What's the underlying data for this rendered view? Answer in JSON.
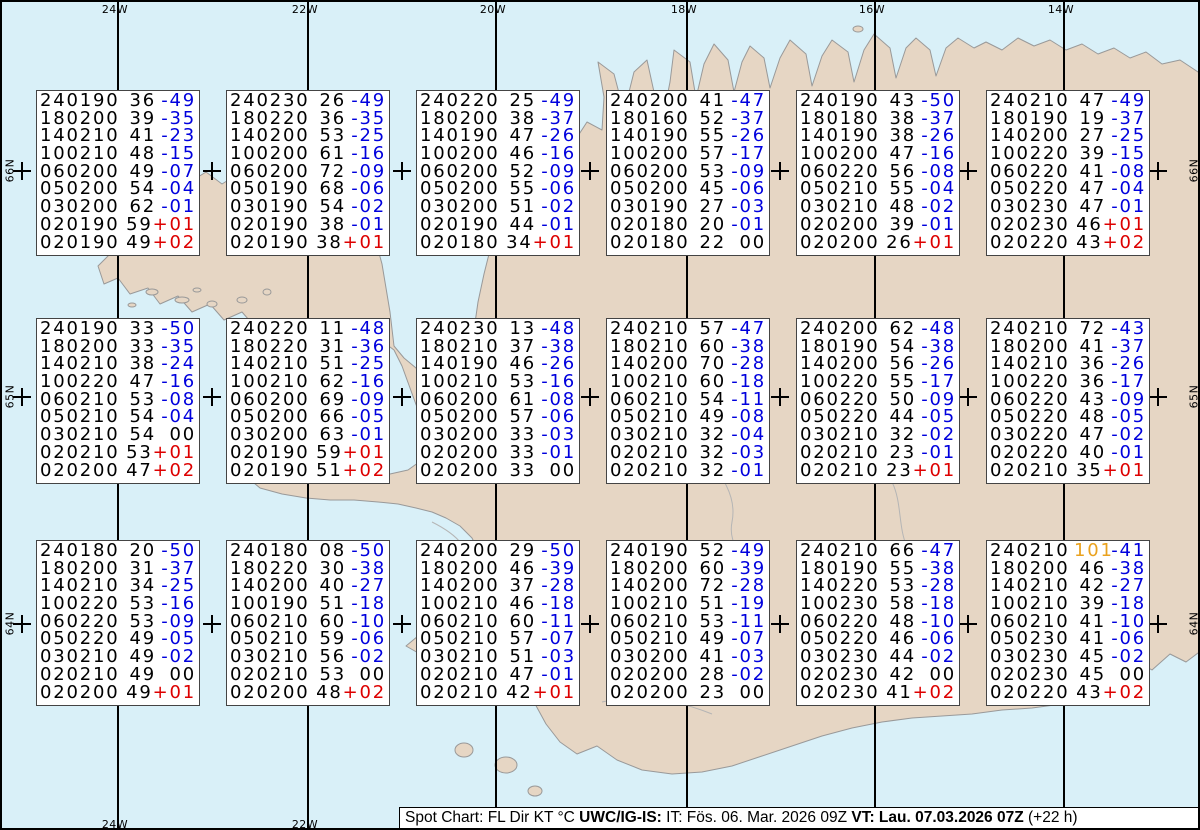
{
  "colors": {
    "ocean": "#d9f0f8",
    "land": "#e6d6c4",
    "coastline": "#999999",
    "grid": "#000000",
    "box_border": "#444444",
    "temp_negative": "#0000dd",
    "temp_positive": "#dd0000",
    "temp_zero": "#000000",
    "kt_strong": "#eaa21e"
  },
  "graticule": {
    "meridians": [
      {
        "label": "24W",
        "x": 115
      },
      {
        "label": "22W",
        "x": 305
      },
      {
        "label": "20W",
        "x": 493
      },
      {
        "label": "18W",
        "x": 684
      },
      {
        "label": "16W",
        "x": 872
      },
      {
        "label": "14W",
        "x": 1061
      }
    ],
    "parallels": [
      {
        "label": "66N",
        "y": 169
      },
      {
        "label": "65N",
        "y": 395
      },
      {
        "label": "64N",
        "y": 622
      }
    ],
    "tick_xs": [
      20,
      115,
      210,
      305,
      400,
      493,
      588,
      684,
      778,
      872,
      966,
      1061,
      1156
    ]
  },
  "stations": {
    "cols_x": [
      34,
      224,
      414,
      604,
      794,
      984
    ],
    "rows_y": [
      88,
      316,
      538
    ],
    "boxes": [
      {
        "rows": [
          [
            "240190",
            "36",
            "-49"
          ],
          [
            "180200",
            "39",
            "-35"
          ],
          [
            "140210",
            "41",
            "-23"
          ],
          [
            "100210",
            "48",
            "-15"
          ],
          [
            "060200",
            "49",
            "-07"
          ],
          [
            "050200",
            "54",
            "-04"
          ],
          [
            "030200",
            "62",
            "-01"
          ],
          [
            "020190",
            "59",
            "+01"
          ],
          [
            "020190",
            "49",
            "+02"
          ]
        ]
      },
      {
        "rows": [
          [
            "240230",
            "26",
            "-49"
          ],
          [
            "180220",
            "36",
            "-35"
          ],
          [
            "140200",
            "53",
            "-25"
          ],
          [
            "100200",
            "61",
            "-16"
          ],
          [
            "060200",
            "72",
            "-09"
          ],
          [
            "050190",
            "68",
            "-06"
          ],
          [
            "030190",
            "54",
            "-02"
          ],
          [
            "020190",
            "38",
            "-01"
          ],
          [
            "020190",
            "38",
            "+01"
          ]
        ]
      },
      {
        "rows": [
          [
            "240220",
            "25",
            "-49"
          ],
          [
            "180200",
            "38",
            "-37"
          ],
          [
            "140190",
            "47",
            "-26"
          ],
          [
            "100200",
            "46",
            "-16"
          ],
          [
            "060200",
            "52",
            "-09"
          ],
          [
            "050200",
            "55",
            "-06"
          ],
          [
            "030200",
            "51",
            "-02"
          ],
          [
            "020190",
            "44",
            "-01"
          ],
          [
            "020180",
            "34",
            "+01"
          ]
        ]
      },
      {
        "rows": [
          [
            "240200",
            "41",
            "-47"
          ],
          [
            "180160",
            "52",
            "-37"
          ],
          [
            "140190",
            "55",
            "-26"
          ],
          [
            "100200",
            "57",
            "-17"
          ],
          [
            "060200",
            "53",
            "-09"
          ],
          [
            "050200",
            "45",
            "-06"
          ],
          [
            "030190",
            "27",
            "-03"
          ],
          [
            "020180",
            "20",
            "-01"
          ],
          [
            "020180",
            "22",
            "00"
          ]
        ]
      },
      {
        "rows": [
          [
            "240190",
            "43",
            "-50"
          ],
          [
            "180180",
            "38",
            "-37"
          ],
          [
            "140190",
            "38",
            "-26"
          ],
          [
            "100200",
            "47",
            "-16"
          ],
          [
            "060220",
            "56",
            "-08"
          ],
          [
            "050210",
            "55",
            "-04"
          ],
          [
            "030210",
            "48",
            "-02"
          ],
          [
            "020200",
            "39",
            "-01"
          ],
          [
            "020200",
            "26",
            "+01"
          ]
        ]
      },
      {
        "rows": [
          [
            "240210",
            "47",
            "-49"
          ],
          [
            "180190",
            "19",
            "-37"
          ],
          [
            "140200",
            "27",
            "-25"
          ],
          [
            "100220",
            "39",
            "-15"
          ],
          [
            "060220",
            "41",
            "-08"
          ],
          [
            "050220",
            "47",
            "-04"
          ],
          [
            "030230",
            "47",
            "-01"
          ],
          [
            "020230",
            "46",
            "+01"
          ],
          [
            "020220",
            "43",
            "+02"
          ]
        ]
      },
      {
        "rows": [
          [
            "240190",
            "33",
            "-50"
          ],
          [
            "180200",
            "33",
            "-35"
          ],
          [
            "140210",
            "38",
            "-24"
          ],
          [
            "100220",
            "47",
            "-16"
          ],
          [
            "060210",
            "53",
            "-08"
          ],
          [
            "050210",
            "54",
            "-04"
          ],
          [
            "030210",
            "54",
            "00"
          ],
          [
            "020210",
            "53",
            "+01"
          ],
          [
            "020200",
            "47",
            "+02"
          ]
        ]
      },
      {
        "rows": [
          [
            "240220",
            "11",
            "-48"
          ],
          [
            "180220",
            "31",
            "-36"
          ],
          [
            "140210",
            "51",
            "-25"
          ],
          [
            "100210",
            "62",
            "-16"
          ],
          [
            "060200",
            "69",
            "-09"
          ],
          [
            "050200",
            "66",
            "-05"
          ],
          [
            "030200",
            "63",
            "-01"
          ],
          [
            "020190",
            "59",
            "+01"
          ],
          [
            "020190",
            "51",
            "+02"
          ]
        ]
      },
      {
        "rows": [
          [
            "240230",
            "13",
            "-48"
          ],
          [
            "180210",
            "37",
            "-38"
          ],
          [
            "140190",
            "46",
            "-26"
          ],
          [
            "100210",
            "53",
            "-16"
          ],
          [
            "060200",
            "61",
            "-08"
          ],
          [
            "050200",
            "57",
            "-06"
          ],
          [
            "030200",
            "33",
            "-03"
          ],
          [
            "020200",
            "33",
            "-01"
          ],
          [
            "020200",
            "33",
            "00"
          ]
        ]
      },
      {
        "rows": [
          [
            "240210",
            "57",
            "-47"
          ],
          [
            "180210",
            "60",
            "-38"
          ],
          [
            "140200",
            "70",
            "-28"
          ],
          [
            "100210",
            "60",
            "-18"
          ],
          [
            "060210",
            "54",
            "-11"
          ],
          [
            "050210",
            "49",
            "-08"
          ],
          [
            "030210",
            "32",
            "-04"
          ],
          [
            "020210",
            "32",
            "-03"
          ],
          [
            "020210",
            "32",
            "-01"
          ]
        ]
      },
      {
        "rows": [
          [
            "240200",
            "62",
            "-48"
          ],
          [
            "180190",
            "54",
            "-38"
          ],
          [
            "140200",
            "56",
            "-26"
          ],
          [
            "100220",
            "55",
            "-17"
          ],
          [
            "060220",
            "50",
            "-09"
          ],
          [
            "050220",
            "44",
            "-05"
          ],
          [
            "030210",
            "32",
            "-02"
          ],
          [
            "020210",
            "23",
            "-01"
          ],
          [
            "020210",
            "23",
            "+01"
          ]
        ]
      },
      {
        "rows": [
          [
            "240210",
            "72",
            "-43"
          ],
          [
            "180200",
            "41",
            "-37"
          ],
          [
            "140210",
            "36",
            "-26"
          ],
          [
            "100220",
            "36",
            "-17"
          ],
          [
            "060220",
            "43",
            "-09"
          ],
          [
            "050220",
            "48",
            "-05"
          ],
          [
            "030220",
            "47",
            "-02"
          ],
          [
            "020220",
            "40",
            "-01"
          ],
          [
            "020210",
            "35",
            "+01"
          ]
        ]
      },
      {
        "rows": [
          [
            "240180",
            "20",
            "-50"
          ],
          [
            "180200",
            "31",
            "-37"
          ],
          [
            "140210",
            "34",
            "-25"
          ],
          [
            "100220",
            "53",
            "-16"
          ],
          [
            "060220",
            "53",
            "-09"
          ],
          [
            "050220",
            "49",
            "-05"
          ],
          [
            "030210",
            "49",
            "-02"
          ],
          [
            "020210",
            "49",
            "00"
          ],
          [
            "020200",
            "49",
            "+01"
          ]
        ]
      },
      {
        "rows": [
          [
            "240180",
            "08",
            "-50"
          ],
          [
            "180220",
            "30",
            "-38"
          ],
          [
            "140200",
            "40",
            "-27"
          ],
          [
            "100190",
            "51",
            "-18"
          ],
          [
            "060210",
            "60",
            "-10"
          ],
          [
            "050210",
            "59",
            "-06"
          ],
          [
            "030210",
            "56",
            "-02"
          ],
          [
            "020210",
            "53",
            "00"
          ],
          [
            "020200",
            "48",
            "+02"
          ]
        ]
      },
      {
        "rows": [
          [
            "240200",
            "29",
            "-50"
          ],
          [
            "180200",
            "46",
            "-39"
          ],
          [
            "140200",
            "37",
            "-28"
          ],
          [
            "100210",
            "46",
            "-18"
          ],
          [
            "060210",
            "60",
            "-11"
          ],
          [
            "050210",
            "57",
            "-07"
          ],
          [
            "030210",
            "51",
            "-03"
          ],
          [
            "020210",
            "47",
            "-01"
          ],
          [
            "020210",
            "42",
            "+01"
          ]
        ]
      },
      {
        "rows": [
          [
            "240190",
            "52",
            "-49"
          ],
          [
            "180200",
            "60",
            "-39"
          ],
          [
            "140200",
            "72",
            "-28"
          ],
          [
            "100210",
            "51",
            "-19"
          ],
          [
            "060210",
            "53",
            "-11"
          ],
          [
            "050210",
            "49",
            "-07"
          ],
          [
            "030200",
            "41",
            "-03"
          ],
          [
            "020200",
            "28",
            "-02"
          ],
          [
            "020200",
            "23",
            "00"
          ]
        ]
      },
      {
        "rows": [
          [
            "240210",
            "66",
            "-47"
          ],
          [
            "180190",
            "55",
            "-38"
          ],
          [
            "140220",
            "53",
            "-28"
          ],
          [
            "100230",
            "58",
            "-18"
          ],
          [
            "060220",
            "48",
            "-10"
          ],
          [
            "050220",
            "46",
            "-06"
          ],
          [
            "030230",
            "44",
            "-02"
          ],
          [
            "020230",
            "42",
            "00"
          ],
          [
            "020230",
            "41",
            "+02"
          ]
        ]
      },
      {
        "rows": [
          [
            "240210",
            "101",
            "-41"
          ],
          [
            "180200",
            "46",
            "-38"
          ],
          [
            "140210",
            "42",
            "-27"
          ],
          [
            "100210",
            "39",
            "-18"
          ],
          [
            "060210",
            "41",
            "-10"
          ],
          [
            "050230",
            "41",
            "-06"
          ],
          [
            "030230",
            "45",
            "-02"
          ],
          [
            "020230",
            "45",
            "00"
          ],
          [
            "020220",
            "43",
            "+02"
          ]
        ]
      }
    ]
  },
  "footer": {
    "segments": [
      {
        "text": "Spot Chart: FL Dir KT °C ",
        "bold": false
      },
      {
        "text": "UWC/IG-IS:",
        "bold": true
      },
      {
        "text": " IT: Fös. 06. Mar. 2026 09Z ",
        "bold": false
      },
      {
        "text": "VT: Lau. 07.03.2026 07Z",
        "bold": true
      },
      {
        "text": " (+22 h)",
        "bold": false
      }
    ]
  }
}
